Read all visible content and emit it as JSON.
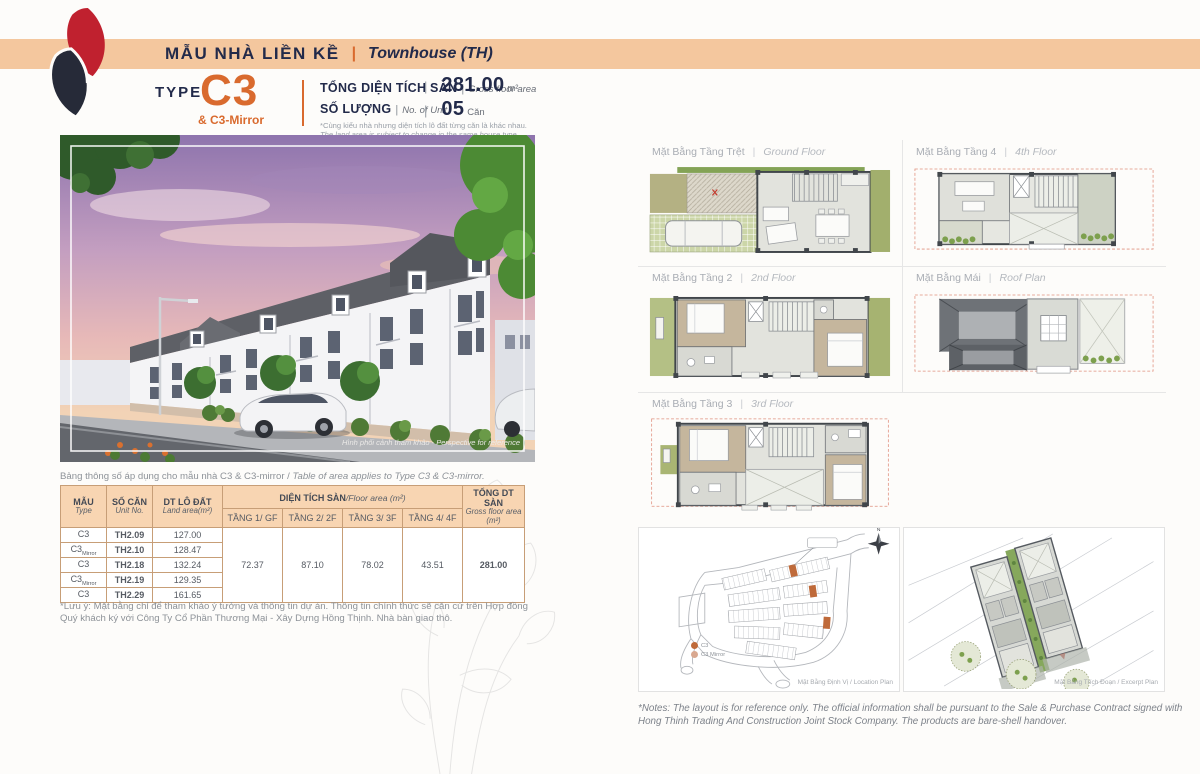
{
  "colors": {
    "accent_orange": "#d96a2e",
    "band_peach": "#f4c79e",
    "navy": "#222a4a",
    "logo_red": "#c0212f",
    "logo_dark": "#262a38",
    "table_border": "#c79e77",
    "table_header_bg": "#f8d5b2"
  },
  "header": {
    "title_vi": "MẪU NHÀ LIỀN KỀ",
    "separator": "|",
    "title_en": "Townhouse (TH)"
  },
  "type_block": {
    "type_label": "TYPE",
    "type_code": "C3",
    "type_sub": "& C3-Mirror",
    "gfa_label_vi": "TỔNG DIỆN TÍCH SÀN",
    "gfa_label_en": "Gross floor area",
    "unit_label_vi": "SỐ LƯỢNG",
    "unit_label_en": "No. of Unit",
    "note_vi": "*Cùng kiểu nhà nhưng diện tích lô đất từng căn là khác nhau.",
    "note_en": "The land area is subject to change in the same house type.",
    "bar": "|",
    "gfa_value": "281.00",
    "gfa_unit": "m²",
    "unit_value": "05",
    "unit_unit": "Căn"
  },
  "photo": {
    "caption": "Hình phối cảnh tham khảo - Perspective for reference"
  },
  "table": {
    "caption_vi": "Bảng thông số áp dụng cho mẫu nhà C3 & C3-mirror / ",
    "caption_en": "Table of area applies to Type C3 & C3-mirror.",
    "headers": {
      "type_vi": "MẪU",
      "type_en": "Type",
      "unit_vi": "SỐ CĂN",
      "unit_en": "Unit No.",
      "land_vi": "DT LÔ ĐẤT",
      "land_en": "Land area(m²)",
      "floor_vi": "DIỆN TÍCH SÀN",
      "floor_en": "/Floor area (m²)",
      "f1": "TẦNG 1/ GF",
      "f2": "TẦNG 2/ 2F",
      "f3": "TẦNG 3/ 3F",
      "f4": "TẦNG 4/ 4F",
      "total_vi": "TỔNG DT SÀN",
      "total_en": "Gross floor area (m²)"
    },
    "rows": [
      {
        "type": "C3",
        "suffix": "",
        "unit": "TH2.09",
        "land": "127.00"
      },
      {
        "type": "C3",
        "suffix": "Mirror",
        "unit": "TH2.10",
        "land": "128.47"
      },
      {
        "type": "C3",
        "suffix": "",
        "unit": "TH2.18",
        "land": "132.24"
      },
      {
        "type": "C3",
        "suffix": "Mirror",
        "unit": "TH2.19",
        "land": "129.35"
      },
      {
        "type": "C3",
        "suffix": "",
        "unit": "TH2.29",
        "land": "161.65"
      }
    ],
    "floor_values": [
      "72.37",
      "87.10",
      "78.02",
      "43.51"
    ],
    "total": "281.00"
  },
  "table_note": "*Lưu ý: Mặt bằng chỉ để tham khảo ý tưởng và thông tin dự án. Thông tin chính thức sẽ căn cứ trên Hợp đồng Quý khách ký với Công Ty Cổ Phần Thương Mại - Xây Dựng Hồng Thịnh. Nhà bàn giao thô.",
  "plans": [
    {
      "label_vi": "Mặt Bằng Tầng Trệt",
      "label_en": "Ground Floor"
    },
    {
      "label_vi": "Mặt Bằng Tầng 4",
      "label_en": "4th Floor"
    },
    {
      "label_vi": "Mặt Bằng Tầng 2",
      "label_en": "2nd Floor"
    },
    {
      "label_vi": "Mặt Bằng Mái",
      "label_en": "Roof Plan"
    },
    {
      "label_vi": "Mặt Bằng Tầng 3",
      "label_en": "3rd Floor"
    }
  ],
  "site": {
    "location": {
      "caption": "Mặt Bằng Định Vị / Location Plan",
      "legend": [
        {
          "label": "C3"
        },
        {
          "label": "C3 Mirror"
        }
      ]
    },
    "excerpt": {
      "caption": "Mặt Bằng Trích Đoạn / Excerpt Plan"
    }
  },
  "footer_note": "*Notes: The layout is for reference only. The official information shall be pursuant to the Sale & Purchase Contract signed with Hong Thinh Trading And Construction Joint Stock Company. The products are bare-shell handover."
}
